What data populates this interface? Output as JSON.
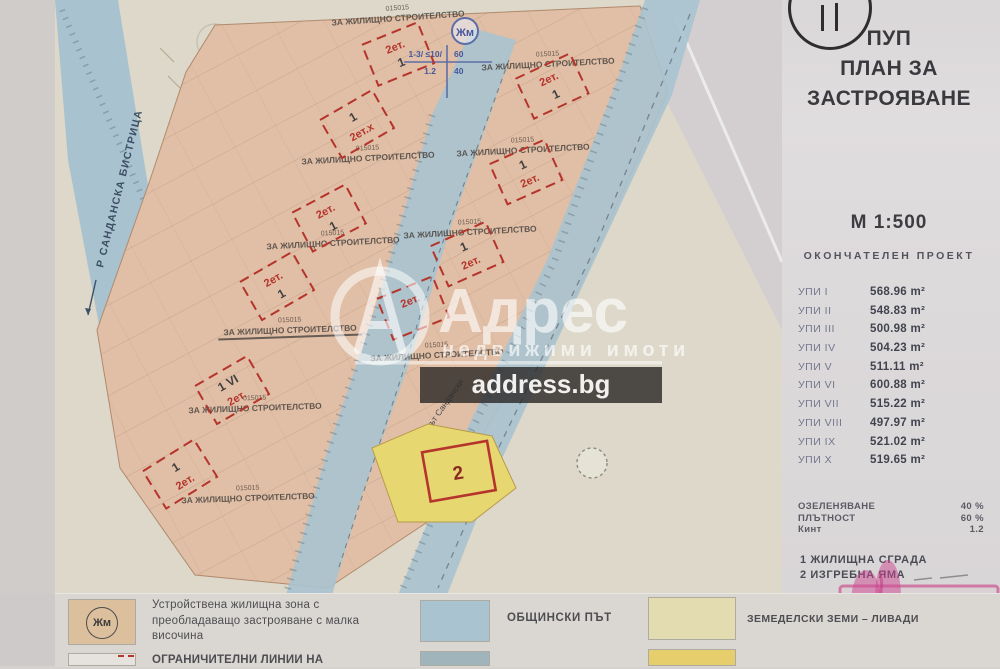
{
  "sidebar": {
    "title_lines": [
      "ПУП",
      "ПЛАН ЗА",
      "ЗАСТРОЯВАНЕ"
    ],
    "scale": "М 1:500",
    "project_status": "ОКОНЧАТЕЛЕН ПРОЕКТ",
    "plots_table": {
      "rows": [
        {
          "label": "УПИ I",
          "area": "568.96 m²"
        },
        {
          "label": "УПИ II",
          "area": "548.83 m²"
        },
        {
          "label": "УПИ III",
          "area": "500.98 m²"
        },
        {
          "label": "УПИ IV",
          "area": "504.23 m²"
        },
        {
          "label": "УПИ V",
          "area": "511.11 m²"
        },
        {
          "label": "УПИ VI",
          "area": "600.88 m²"
        },
        {
          "label": "УПИ VII",
          "area": "515.22 m²"
        },
        {
          "label": "УПИ VIII",
          "area": "497.97 m²"
        },
        {
          "label": "УПИ IX",
          "area": "521.02 m²"
        },
        {
          "label": "УПИ X",
          "area": "519.65 m²"
        }
      ]
    },
    "parameters": [
      {
        "label": "ОЗЕЛЕНЯВАНЕ",
        "value": "40 %"
      },
      {
        "label": "ПЛЪТНОСТ",
        "value": "60 %"
      },
      {
        "label": "Кинт",
        "value": "1.2"
      }
    ],
    "notes": [
      "1 ЖИЛИЩНА СГРАДА",
      "2 ИЗГРЕБНА ЯМА"
    ]
  },
  "watermark": {
    "letter": "А",
    "brand": "Адрес",
    "subtitle": "недвижими  имоти",
    "domain": "address.bg"
  },
  "map": {
    "river_label": "Р САНДАНСКА БИСТРИЦА",
    "road_label": "път Сандански",
    "zone_symbol": "Жм",
    "zone_notation": {
      "tl": "1-3/ ≤10/",
      "bl": "1.2",
      "tr": "60",
      "br": "40"
    },
    "use_number": "015015",
    "use_text": "ЗА ЖИЛИЩНО СТРОИТЕЛСТВО",
    "pit_number": "2",
    "markers": [
      {
        "x": 398,
        "y": 54,
        "r": -22,
        "a": "2ет.",
        "b": "1"
      },
      {
        "x": 552,
        "y": 86,
        "r": -25,
        "a": "2ет.",
        "b": "1"
      },
      {
        "x": 357,
        "y": 124,
        "r": -30,
        "a": "1",
        "b": "2ет.х"
      },
      {
        "x": 526,
        "y": 172,
        "r": -24,
        "a": "1",
        "b": "2ет."
      },
      {
        "x": 329,
        "y": 218,
        "r": -28,
        "a": "2ет.",
        "b": "1"
      },
      {
        "x": 467,
        "y": 254,
        "r": -24,
        "a": "1",
        "b": "2ет."
      },
      {
        "x": 277,
        "y": 286,
        "r": -30,
        "a": "2ет.",
        "b": "1"
      },
      {
        "x": 413,
        "y": 308,
        "r": -22,
        "a": "2ет.",
        "b": ""
      },
      {
        "x": 232,
        "y": 390,
        "r": -30,
        "a": "1 VI",
        "b": "2ет."
      },
      {
        "x": 180,
        "y": 474,
        "r": -32,
        "a": "1",
        "b": "2ет."
      }
    ],
    "use_labels": [
      {
        "x": 398,
        "y": 18,
        "r": -4,
        "u": false
      },
      {
        "x": 548,
        "y": 64,
        "r": -3,
        "u": false
      },
      {
        "x": 523,
        "y": 150,
        "r": -3,
        "u": false
      },
      {
        "x": 368,
        "y": 158,
        "r": -3,
        "u": false
      },
      {
        "x": 470,
        "y": 232,
        "r": -3,
        "u": false
      },
      {
        "x": 333,
        "y": 243,
        "r": -3,
        "u": false
      },
      {
        "x": 290,
        "y": 330,
        "r": -2,
        "u": true
      },
      {
        "x": 437,
        "y": 355,
        "r": -3,
        "u": false
      },
      {
        "x": 255,
        "y": 408,
        "r": -2,
        "u": false
      },
      {
        "x": 248,
        "y": 498,
        "r": -2,
        "u": false
      }
    ]
  },
  "legend": {
    "items": [
      {
        "label": "Устройствена жилищна зона с\nпреобладаващо застрояване с малка\nвисочина"
      },
      {
        "label": "ОГРАНИЧИТЕЛНИ ЛИНИИ НА"
      },
      {
        "label": "ОБЩИНСКИ ПЪТ"
      },
      {
        "label": "ЗЕМЕДЕЛСКИ ЗЕМИ – ЛИВАДИ"
      }
    ],
    "zone_symbol": "Жм"
  }
}
